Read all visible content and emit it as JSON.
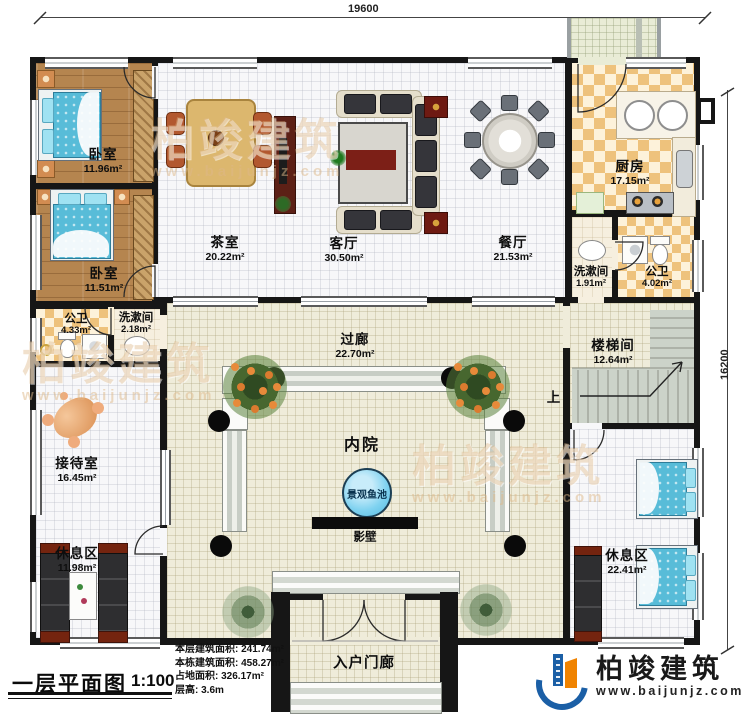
{
  "dimensions": {
    "top": "19600",
    "right": "16200"
  },
  "rooms": [
    {
      "id": "bedroom-1",
      "name": "卧室",
      "area": "11.96m²"
    },
    {
      "id": "bedroom-2",
      "name": "卧室",
      "area": "11.51m²"
    },
    {
      "id": "tea-room",
      "name": "茶室",
      "area": "20.22m²"
    },
    {
      "id": "living-room",
      "name": "客厅",
      "area": "30.50m²"
    },
    {
      "id": "dining-room",
      "name": "餐厅",
      "area": "21.53m²"
    },
    {
      "id": "kitchen",
      "name": "厨房",
      "area": "17.15m²"
    },
    {
      "id": "washroom-right",
      "name": "洗漱间",
      "area": "1.91m²"
    },
    {
      "id": "toilet-right",
      "name": "公卫",
      "area": "4.02m²"
    },
    {
      "id": "toilet-left",
      "name": "公卫",
      "area": "4.33m²"
    },
    {
      "id": "washroom-left",
      "name": "洗漱间",
      "area": "2.18m²"
    },
    {
      "id": "corridor",
      "name": "过廊",
      "area": "22.70m²"
    },
    {
      "id": "stair-hall",
      "name": "楼梯间",
      "area": "12.64m²"
    },
    {
      "id": "reception",
      "name": "接待室",
      "area": "16.45m²"
    },
    {
      "id": "rest-area-left",
      "name": "休息区",
      "area": "11.98m²"
    },
    {
      "id": "rest-area-right",
      "name": "休息区",
      "area": "22.41m²"
    }
  ],
  "courtyard": {
    "name": "内院",
    "pond_label": "景观鱼池",
    "screen_wall_label": "影壁",
    "stairs_up": "上"
  },
  "porch": {
    "label": "入户门廊"
  },
  "titleblock": {
    "title": "一层平面图",
    "scale": "1:100",
    "stats": [
      {
        "label": "本层建筑面积:",
        "value": "241.74m²"
      },
      {
        "label": "本栋建筑面积:",
        "value": "458.27m²"
      },
      {
        "label": "占地面积:",
        "value": "326.17m²"
      },
      {
        "label": "层高:",
        "value": "3.6m"
      }
    ]
  },
  "logo": {
    "brand": "柏竣建筑",
    "website": "www.baijunjz.com"
  },
  "watermark": {
    "brand": "柏竣建筑",
    "website": "www.baijunjz.com"
  },
  "colors": {
    "wall": "#161616",
    "wood": "#b5854f",
    "tile": "#f7f7f9",
    "beige": "#efecda",
    "checker": "#eec27c",
    "pond": "#7fd2f0",
    "brand_blue": "#1b5fa6",
    "brand_orange": "#f08300"
  }
}
